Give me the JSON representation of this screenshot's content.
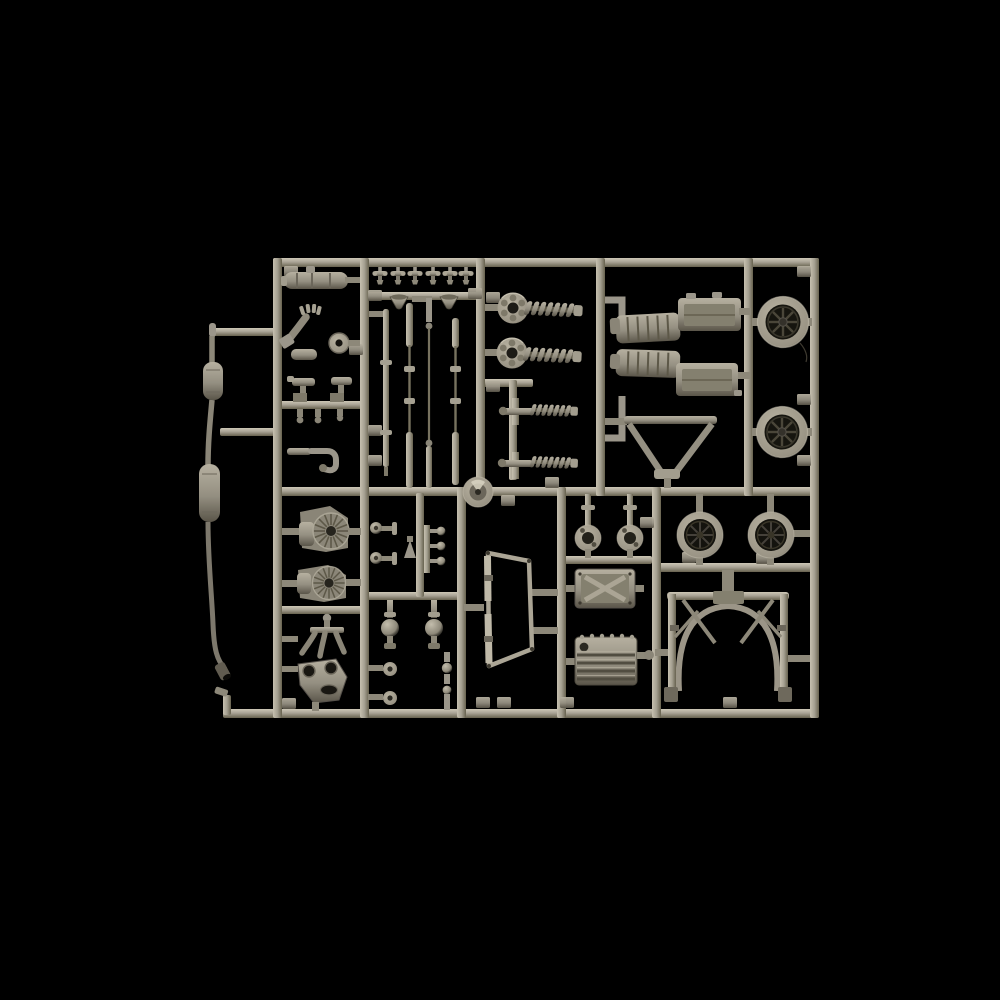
{
  "meta": {
    "title": "Model kit sprue photograph",
    "description": "Photograph of a grey-khaki injection-moulded plastic model kit sprue (parts tree) on a black background, containing car model parts: exhaust pipe with mufflers, wheels, wheel rims, coil-spring shock absorbers, muffler assemblies, axle and tie rods, gearbox drums, roll bar, windscreen frame, oil pan and small fittings."
  },
  "scene": {
    "background_color": "#000000",
    "sprue_base_color": "#a9a395",
    "sprue_highlight_color": "#cac4b3",
    "sprue_shadow_color": "#6e695c",
    "part_base_color": "#948f81",
    "dark_detail_color": "#1d1b16",
    "tire_color": "#16150f"
  },
  "parts": [
    {
      "name": "exhaust-pipe-with-mufflers"
    },
    {
      "name": "fuel-tank-cylinder"
    },
    {
      "name": "manifold-arm"
    },
    {
      "name": "small-disc"
    },
    {
      "name": "carburetor-bodies"
    },
    {
      "name": "j-shaped-pipe"
    },
    {
      "name": "poppet-valves",
      "count": 6
    },
    {
      "name": "velocity-stack-funnels",
      "count": 2
    },
    {
      "name": "axle-and-tie-rods",
      "count": 4
    },
    {
      "name": "steering-hub-disc"
    },
    {
      "name": "shock-absorbers-with-springs",
      "count": 2
    },
    {
      "name": "coil-spring-units",
      "count": 2
    },
    {
      "name": "muffler-engine-assemblies",
      "count": 2
    },
    {
      "name": "lower-wishbone"
    },
    {
      "name": "front-wheels",
      "count": 2
    },
    {
      "name": "finned-gearbox-drums",
      "count": 2
    },
    {
      "name": "pedal-claw"
    },
    {
      "name": "suspension-arm-plate"
    },
    {
      "name": "ball-joints",
      "count": 2
    },
    {
      "name": "linkage-pins"
    },
    {
      "name": "windscreen-frame"
    },
    {
      "name": "pulleys",
      "count": 2
    },
    {
      "name": "x-pattern-gearbox-cover"
    },
    {
      "name": "finned-oil-pan"
    },
    {
      "name": "wheel-rims",
      "count": 2
    },
    {
      "name": "roll-bar-cage"
    }
  ]
}
